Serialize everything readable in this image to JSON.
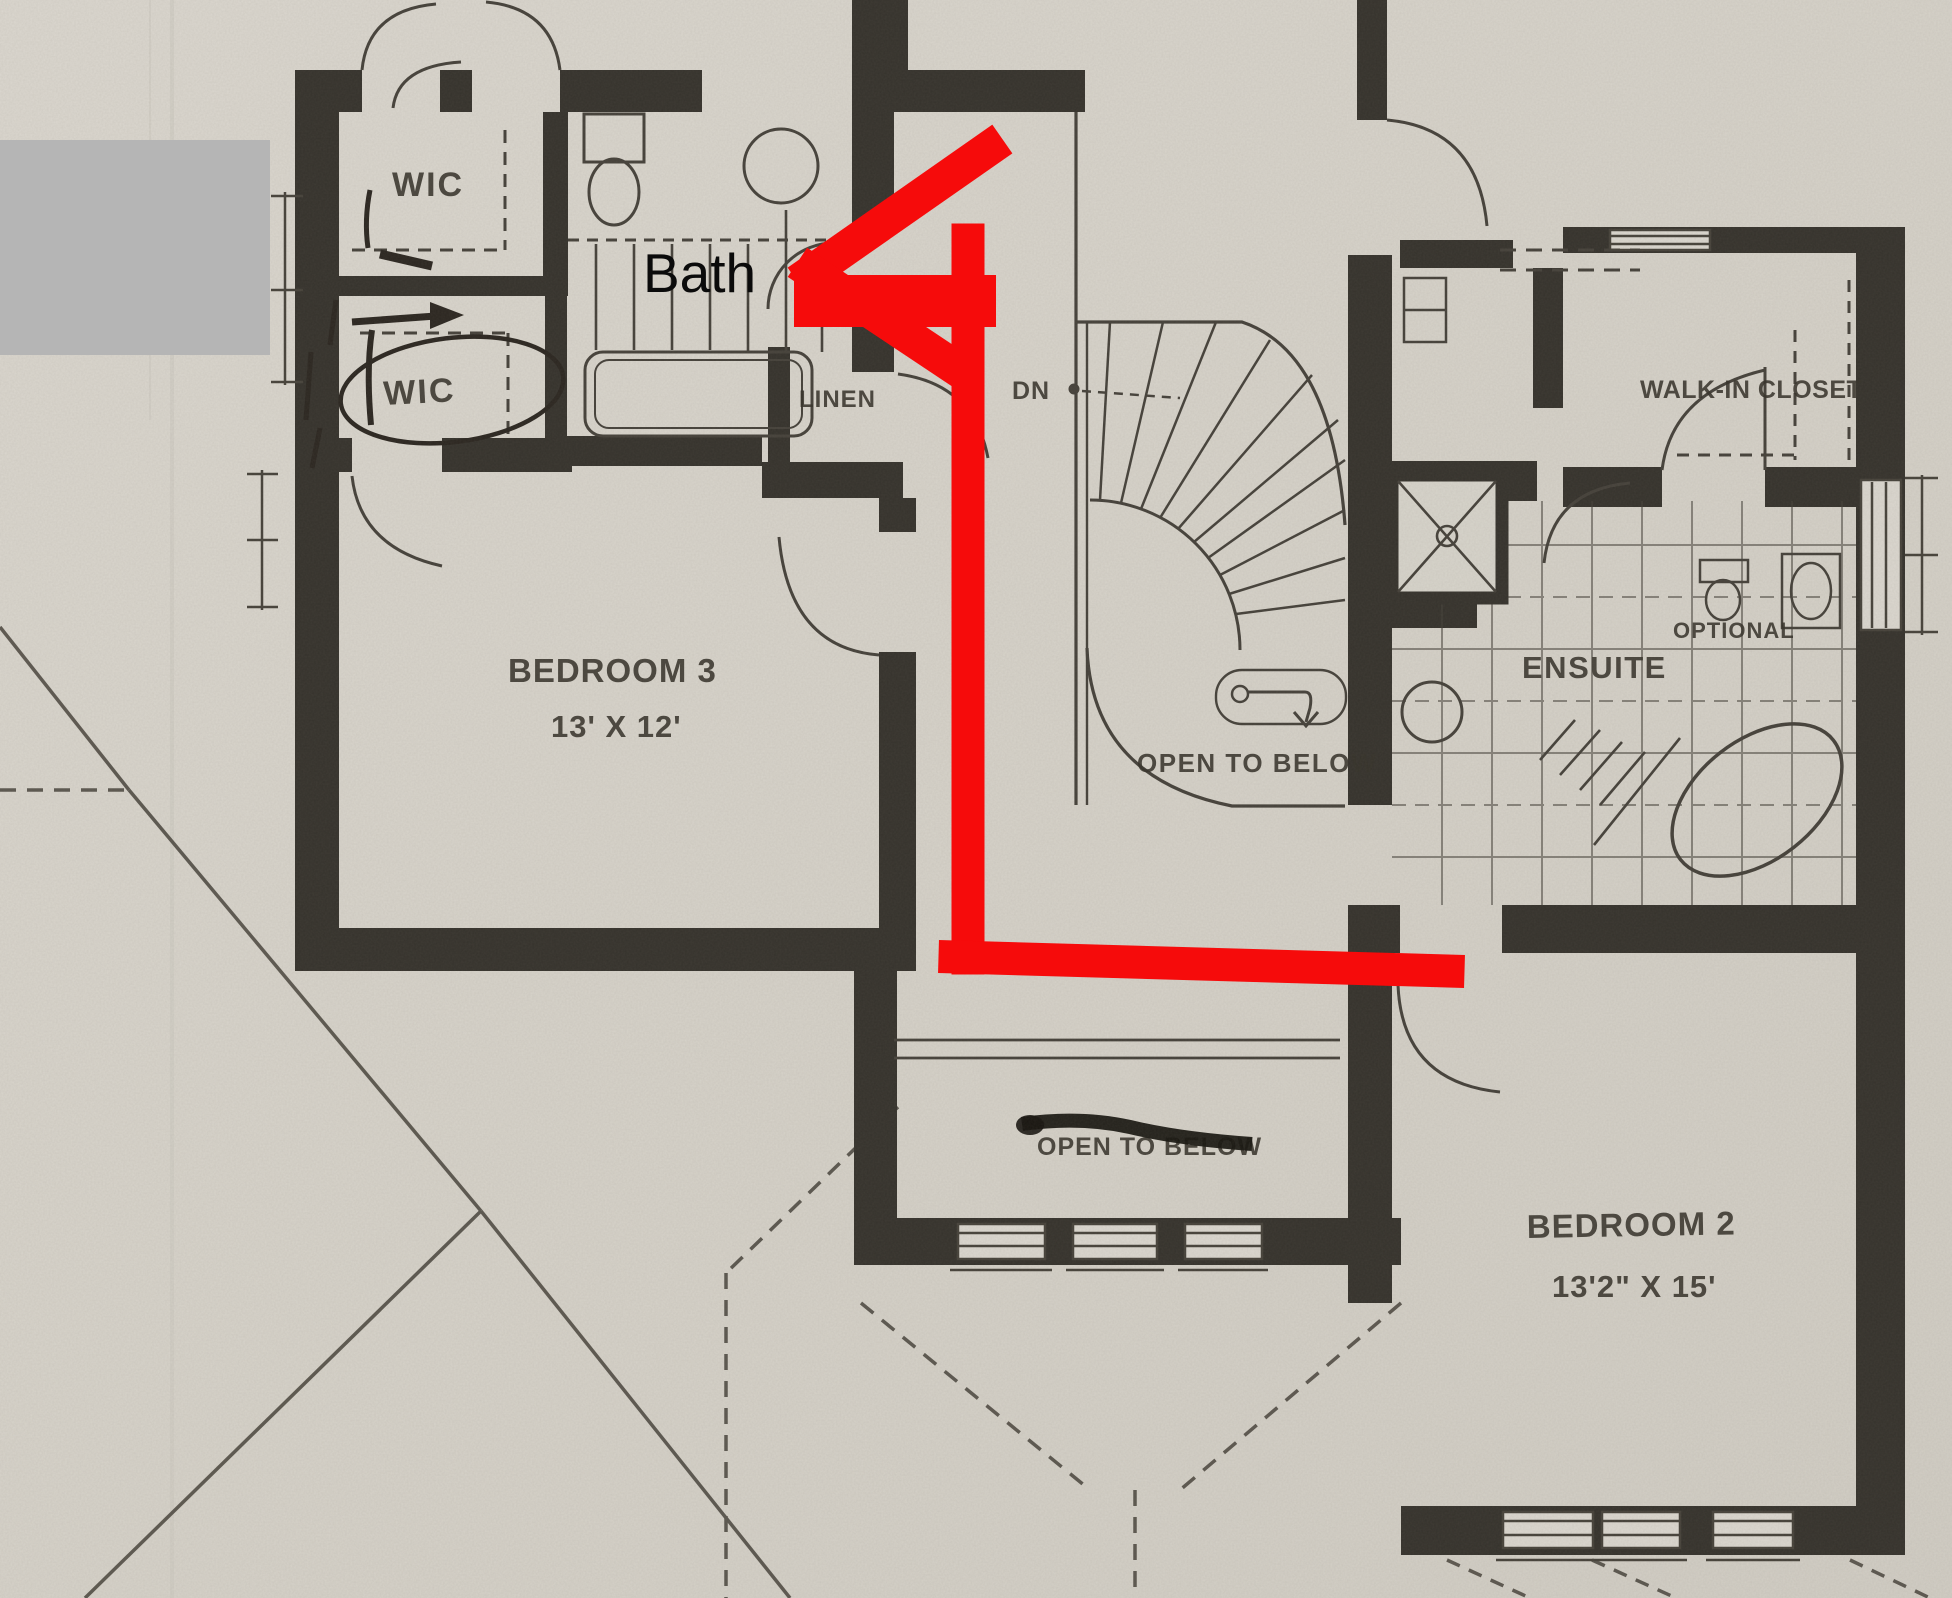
{
  "overlay": {
    "bath_label": "Bath",
    "annotation_arrow": "red-route-arrow-pointing-to-bath",
    "redaction": "gray-redaction-box"
  },
  "colors": {
    "paper": "#d8d4cb",
    "wall": "#35322c",
    "ink": "#45413a",
    "label_ink": "#36322a",
    "annotation_red": "#f60b0b",
    "redaction_gray": "#b5b5b5",
    "overlay_text_black": "#0b0b0b"
  },
  "labels": {
    "wic_upper": "WIC",
    "wic_lower": "WIC",
    "linen": "LINEN",
    "down": "DN",
    "open_to_below_stairs": "OPEN TO BELOW",
    "bedroom3_name": "BEDROOM 3",
    "bedroom3_dims": "13' X 12'",
    "walk_in_closet": "WALK-IN CLOSET",
    "ensuite": "ENSUITE",
    "optional": "OPTIONAL",
    "bedroom2_name": "BEDROOM 2",
    "bedroom2_dims": "13'2\" X 15'",
    "open_to_below_struck": "OPEN TO BELOW"
  }
}
